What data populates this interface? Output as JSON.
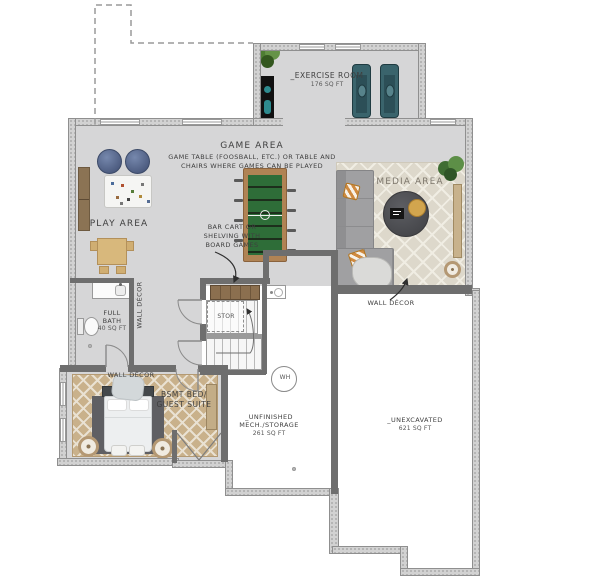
{
  "plan_title": "Basement Floor Plan",
  "colors": {
    "floor_finished": "#d6d6d7",
    "wall_exterior": "#d2d2d2",
    "wall_interior": "#6e6e6e",
    "rug_media": "#ddd8cb",
    "rug_bedroom": "#c9b18b",
    "accent_teal": "#3a646c",
    "accent_wood": "#8b6f4f",
    "beanbag_blue": "#5c6d92",
    "foosball_green": "#2e6d38"
  },
  "rooms": {
    "exercise": {
      "label": "_EXERCISE ROOM",
      "sqft": "176 SQ FT"
    },
    "game": {
      "label": "GAME AREA",
      "note1": "GAME TABLE (FOOSBALL, ETC.) OR  TABLE AND",
      "note2": "CHAIRS WHERE GAMES CAN BE PLAYED"
    },
    "play": {
      "label": "PLAY AREA"
    },
    "media": {
      "label": "MEDIA AREA"
    },
    "full_bath": {
      "line1": "FULL",
      "line2": "BATH",
      "sqft": "40 SQ FT"
    },
    "bsmt_bed": {
      "line1": "BSMT BED/",
      "line2": "GUEST SUITE"
    },
    "mech": {
      "line1": "_UNFINISHED",
      "line2": "MECH./STORAGE",
      "sqft": "261 SQ FT"
    },
    "unexcavated": {
      "label": "_UNEXCAVATED",
      "sqft": "621 SQ FT"
    },
    "stor": {
      "label": "STOR"
    }
  },
  "annotations": {
    "bar_cart": {
      "line1": "BAR CART OR",
      "line2": "SHELVING WITH",
      "line3": "BOARD GAMES"
    },
    "wall_decor": "WALL DÉCOR",
    "water_heater": "WH"
  }
}
